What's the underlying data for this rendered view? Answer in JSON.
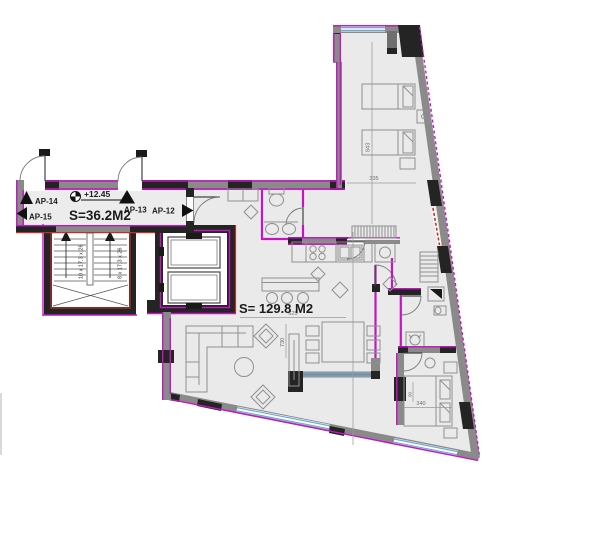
{
  "plan": {
    "corridor": {
      "apartment_labels": {
        "ap14": "AP-14",
        "ap15": "AP-15",
        "ap13": "AP-13",
        "ap12": "AP-12"
      },
      "level_mark": "+12.45",
      "area_label": "S=36.2M2"
    },
    "apartment": {
      "area_label": "S= 129.8 M2"
    },
    "stairs": {
      "flight_left_label": "10 x 17,3 x 26",
      "flight_right_label": "8 x 17,3 x 26"
    },
    "dimensions": {
      "d843": "843",
      "d335": "335",
      "d625": "625",
      "d730": "730",
      "d340": "340",
      "d90": "90"
    },
    "colors": {
      "wall_accent_magenta": "#c414c4",
      "stair_accent_red": "#c03026",
      "window_blue": "#6fa8d2",
      "wall_dark": "#242424",
      "wall_gray": "#8a8a8a",
      "floor_gray": "#eaeaea"
    }
  }
}
